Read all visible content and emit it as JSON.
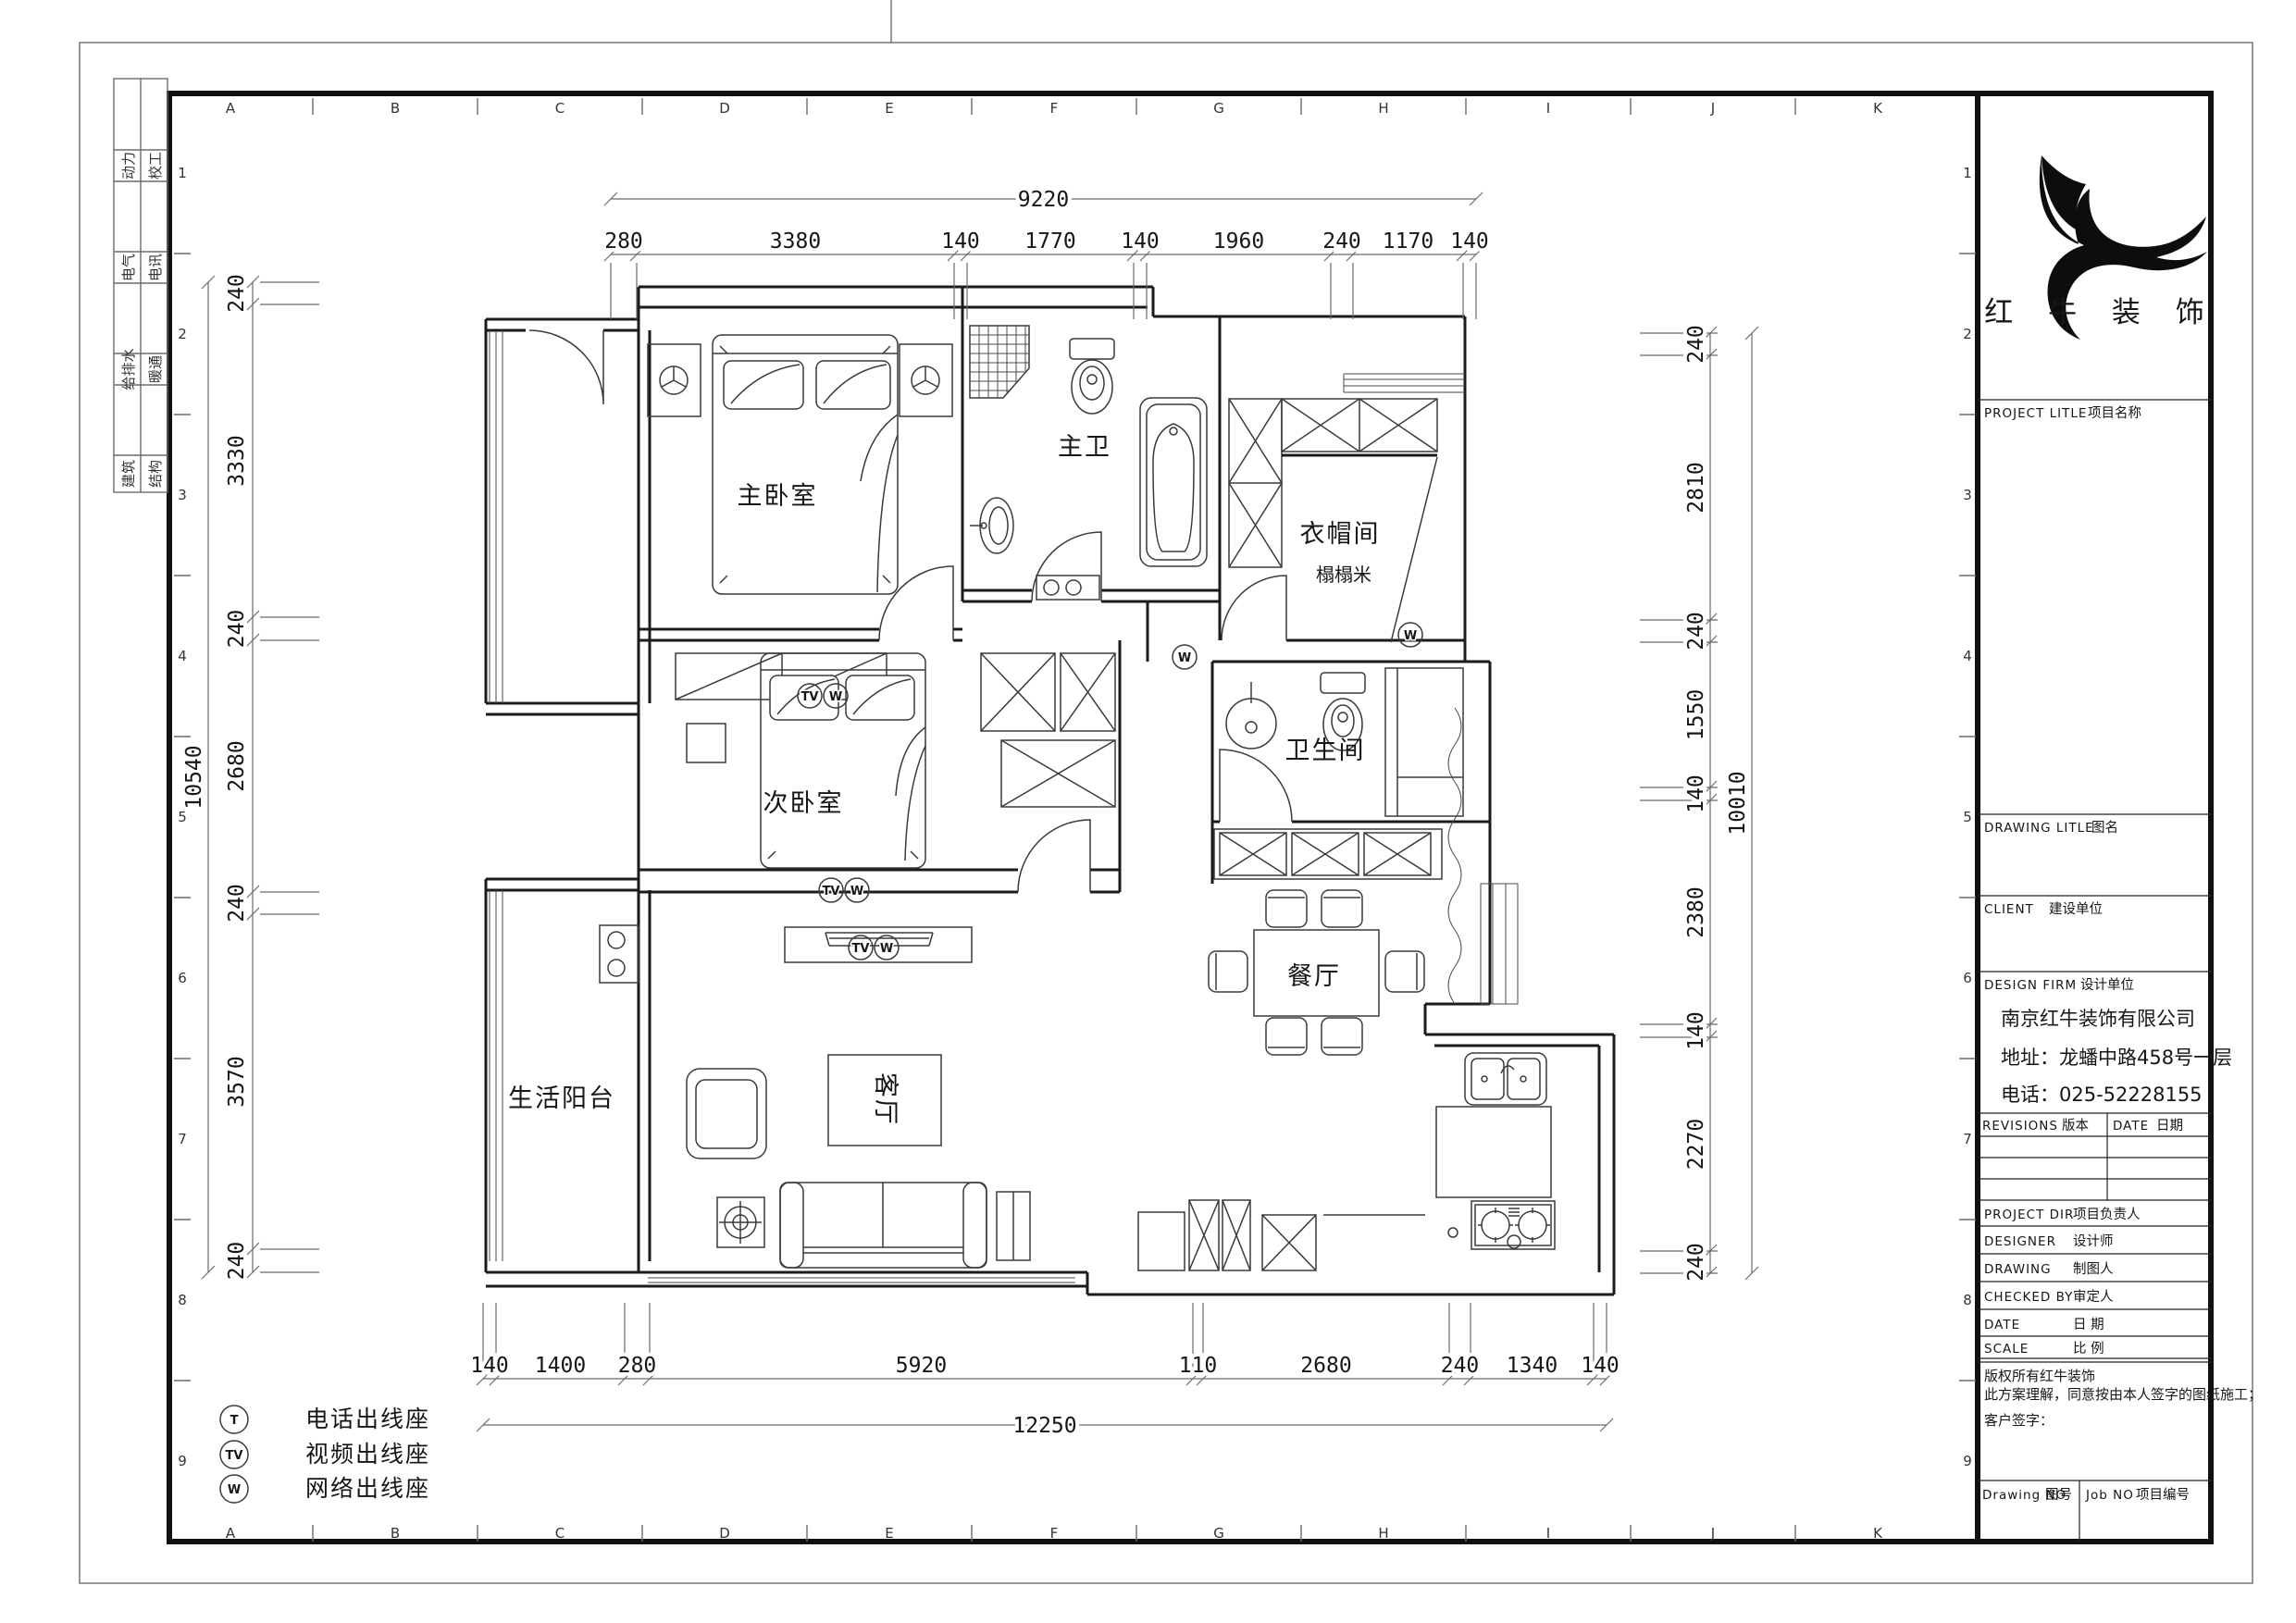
{
  "frame": {
    "grid_letters": [
      "A",
      "B",
      "C",
      "D",
      "E",
      "F",
      "G",
      "H",
      "I",
      "J",
      "K"
    ],
    "grid_numbers": [
      "1",
      "2",
      "3",
      "4",
      "5",
      "6",
      "7",
      "8",
      "9"
    ]
  },
  "discipline_table": {
    "col1": [
      "动力",
      "电气",
      "给排水",
      "建筑"
    ],
    "col2": [
      "校工",
      "电讯",
      "暖通",
      "结构"
    ]
  },
  "rooms": {
    "master": "主卧室",
    "master_bath": "主卫",
    "cloak": "衣帽间",
    "tatami": "榻榻米",
    "bed2": "次卧室",
    "bath": "卫生间",
    "dining": "餐厅",
    "living": "客厅",
    "balcony": "生活阳台"
  },
  "outlets": {
    "t": "T",
    "tv": "TV",
    "w": "W"
  },
  "legend": {
    "items": [
      {
        "symbol": "T",
        "label": "电话出线座"
      },
      {
        "symbol": "TV",
        "label": "视频出线座"
      },
      {
        "symbol": "W",
        "label": "网络出线座"
      }
    ]
  },
  "dimensions": {
    "top_overall": "9220",
    "top": [
      "280",
      "3380",
      "140",
      "1770",
      "140",
      "1960",
      "240",
      "1170",
      "140"
    ],
    "bottom_overall": "12250",
    "bottom": [
      "140",
      "1400",
      "280",
      "5920",
      "110",
      "2680",
      "240",
      "1340",
      "140"
    ],
    "left_overall": "10540",
    "left": [
      "240",
      "3330",
      "240",
      "2680",
      "240",
      "3570",
      "240"
    ],
    "right_overall": "10010",
    "right": [
      "240",
      "2810",
      "240",
      "1550",
      "140",
      "2380",
      "140",
      "2270",
      "240"
    ]
  },
  "title_block": {
    "company_logo_name": "redbull-logo",
    "company_name": "红 牛 装 饰",
    "project_title_en": "PROJECT LITLE",
    "project_title_cn": "项目名称",
    "drawing_title_en": "DRAWING LITLE",
    "drawing_title_cn": "图名",
    "client_en": "CLIENT",
    "client_cn": "建设单位",
    "design_firm_en": "DESIGN FIRM",
    "design_firm_cn": "设计单位",
    "firm_name": "南京红牛装饰有限公司",
    "firm_address": "地址：龙蟠中路458号一层",
    "firm_phone": "电话：025-52228155",
    "revisions_en": "REVISIONS",
    "revisions_cn": "版本",
    "date_en": "DATE",
    "date_cn": "日期",
    "project_dir_en": "PROJECT DIR",
    "project_dir_cn": "项目负责人",
    "designer_en": "DESIGNER",
    "designer_cn": "设计师",
    "drawing_by_en": "DRAWING",
    "drawing_by_cn": "制图人",
    "checked_en": "CHECKED BY",
    "checked_cn": "审定人",
    "date2_en": "DATE",
    "date2_cn": "日  期",
    "scale_en": "SCALE",
    "scale_cn": "比  例",
    "copyright_line": "版权所有红牛装饰",
    "agreement_line": "此方案理解，同意按由本人签字的图纸施工；",
    "signature_line": "客户签字：",
    "drawing_no_en": "Drawing NO",
    "drawing_no_cn": "图号",
    "job_no_en": "Job NO",
    "job_no_cn": "项目编号"
  }
}
